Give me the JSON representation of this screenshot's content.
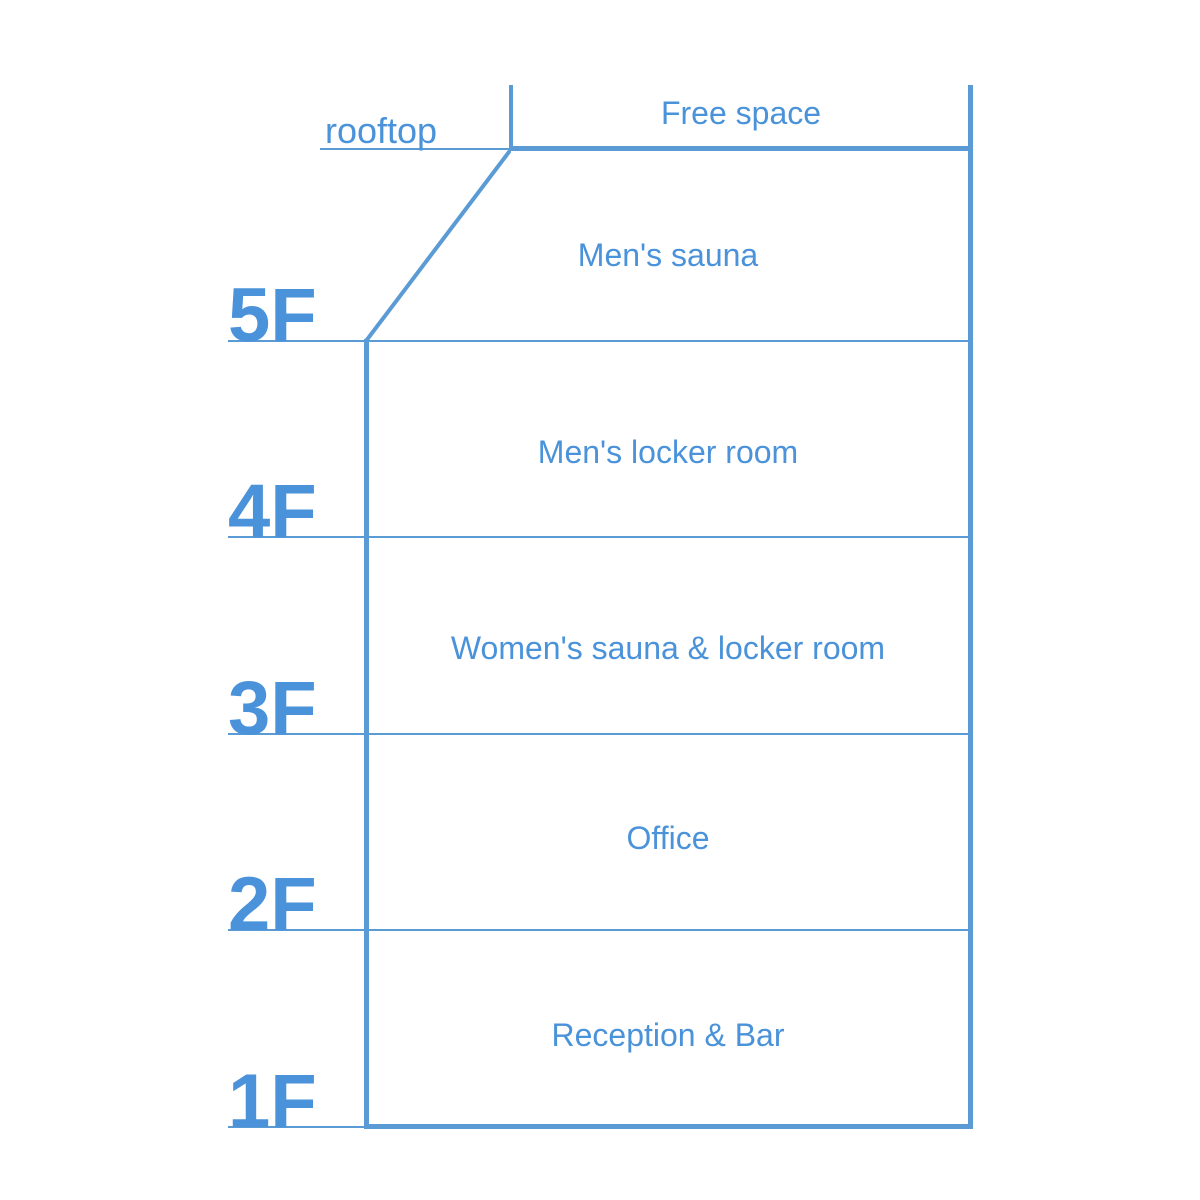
{
  "palette": {
    "accent": "#5B9BD5",
    "label_text": "#4A92D9",
    "background": "#FFFFFF"
  },
  "building": {
    "floors": [
      {
        "level": "rooftop",
        "room": "Free space"
      },
      {
        "level": "5F",
        "room": "Men's sauna"
      },
      {
        "level": "4F",
        "room": "Men's locker room"
      },
      {
        "level": "3F",
        "room": "Women's sauna & locker room"
      },
      {
        "level": "2F",
        "room": "Office"
      },
      {
        "level": "1F",
        "room": "Reception & Bar"
      }
    ]
  }
}
